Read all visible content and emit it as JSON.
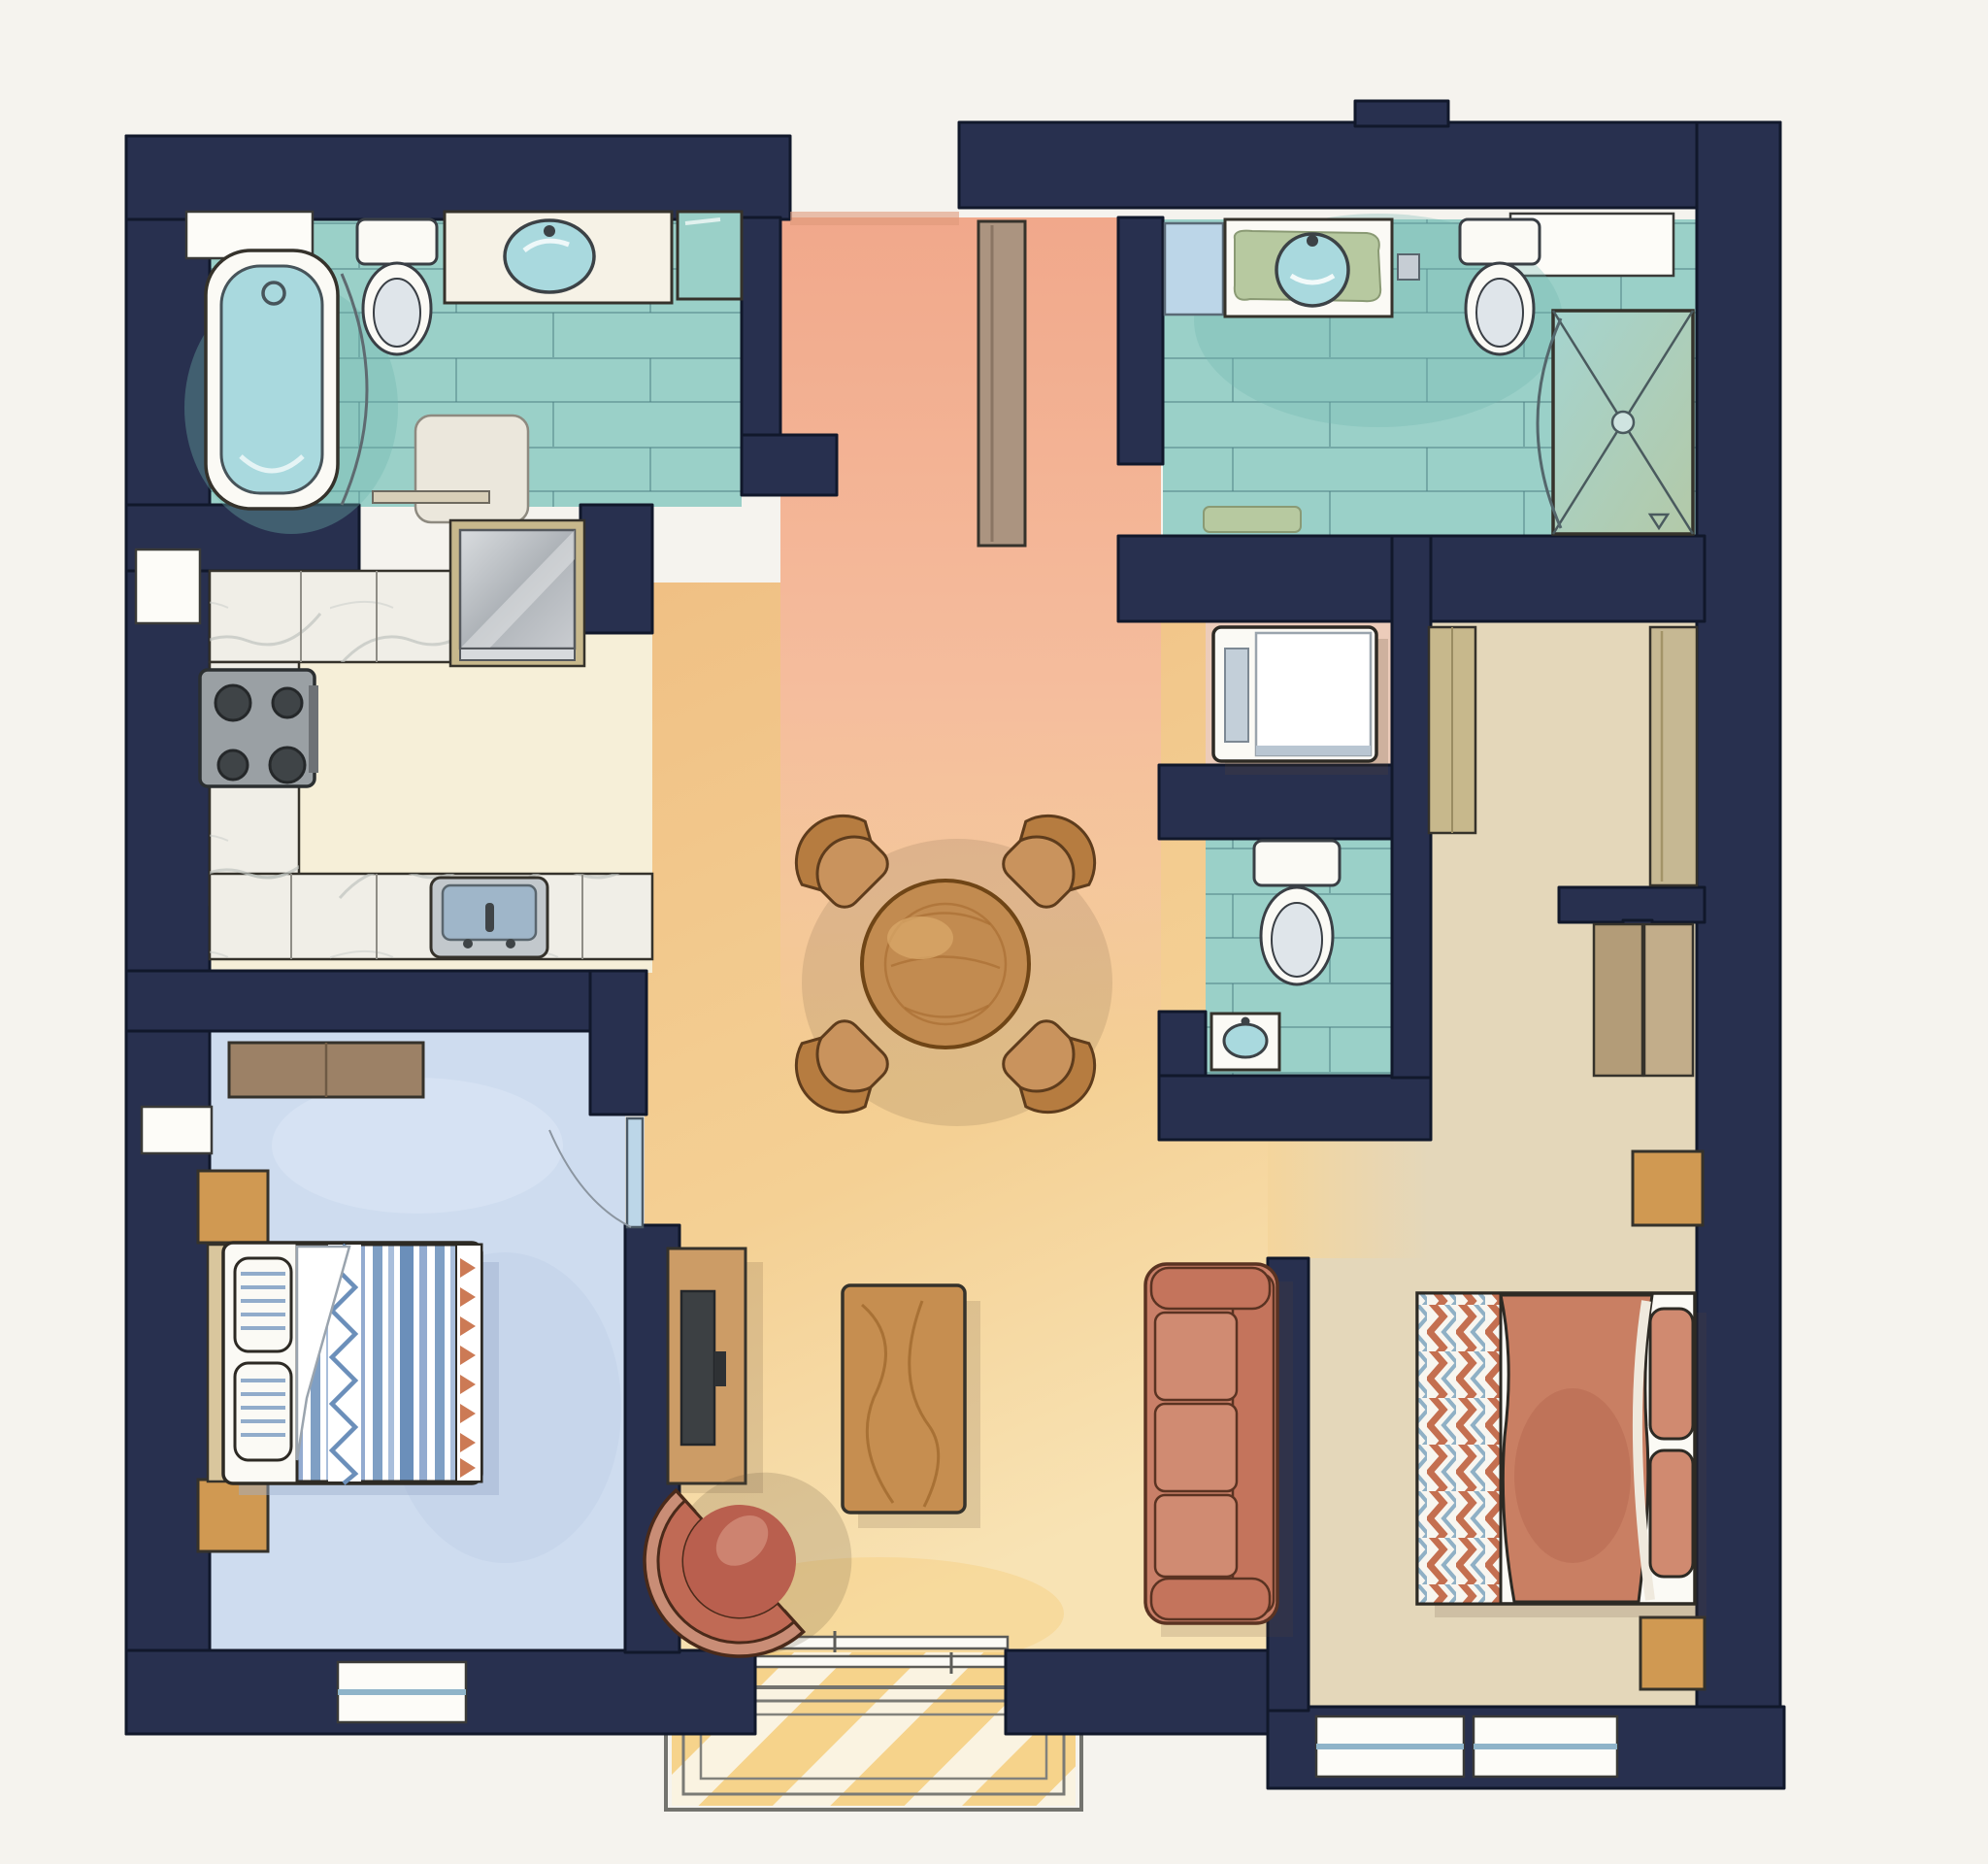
{
  "palette": {
    "paper": "#f5f3ee",
    "wall": "#28304f",
    "wall_line": "#11182b",
    "ink": "#35322b",
    "teal_floor": "#9ad0c8",
    "teal_deep": "#6fb7ae",
    "tile_line": "#4d8084",
    "tub_water": "#a9d9de",
    "fixture_white": "#fbfaf5",
    "fixture_grey": "#c6cdd4",
    "salmon": "#f1a88b",
    "salmon_light": "#f6c5a4",
    "amber": "#f2cb90",
    "amber_light": "#f8e3b8",
    "cream": "#f6efd8",
    "marble": "#f0eee7",
    "marble_vein": "#bcc0bc",
    "steel": "#b7bcc1",
    "stove": "#9aa0a4",
    "burner": "#3f4447",
    "blue_floor": "#cedcef",
    "tan_floor": "#e4d7ba",
    "khaki": "#c7b88c",
    "door_wood": "#ab9480",
    "green_mat": "#b7c9a0",
    "glass_blue": "#bcd6e8",
    "wood_table": "#c28b50",
    "chair_wood": "#c9935d",
    "coffee_wood": "#c68e50",
    "console_wood": "#cc9c66",
    "tv_dark": "#3c4043",
    "sofa": "#c97f68",
    "sofa_light": "#d08b72",
    "accent_chair": "#c06a55",
    "coral": "#c97f63",
    "chev_blue": "#8fb0c5",
    "stripe_blue": "#7f9fc4",
    "dresser": "#9c8166",
    "nightstand": "#d09952",
    "headboard": "#d9c69d",
    "sun": "#f6cf80",
    "closet_floor": "#ecccba",
    "shadow": "#5b4632"
  },
  "rooms": [
    {
      "id": "bathroom-main",
      "features": [
        "bathtub",
        "toilet",
        "vanity-sink",
        "tiled-floor",
        "window-niche",
        "bath-mat",
        "shower-curtain"
      ]
    },
    {
      "id": "kitchen",
      "features": [
        "stove-4-burners",
        "refrigerator",
        "kitchen-sink",
        "l-shaped-marble-counter"
      ]
    },
    {
      "id": "bedroom-left",
      "features": [
        "double-bed-striped",
        "dresser",
        "nightstand",
        "nightstand",
        "window",
        "door"
      ]
    },
    {
      "id": "entry-hallway",
      "features": [
        "open-entry",
        "entry-door-leaf"
      ]
    },
    {
      "id": "living-dining",
      "features": [
        "round-dining-table",
        "four-chairs",
        "sofa",
        "coffee-table",
        "tv-console",
        "accent-chair",
        "patio-opening",
        "porch-steps",
        "sunlight"
      ]
    },
    {
      "id": "bathroom-second",
      "features": [
        "vanity-sink",
        "green-mat",
        "toilet",
        "shower-stall",
        "towel-shelf",
        "window-niche",
        "bath-mat"
      ]
    },
    {
      "id": "laundry-closet",
      "features": [
        "washer"
      ]
    },
    {
      "id": "water-closet",
      "features": [
        "toilet",
        "hand-sink"
      ]
    },
    {
      "id": "bedroom-right",
      "features": [
        "double-bed-chevron",
        "nightstand",
        "nightstand",
        "wardrobe",
        "closet-sliding-doors",
        "door-leaf",
        "windows"
      ]
    }
  ]
}
